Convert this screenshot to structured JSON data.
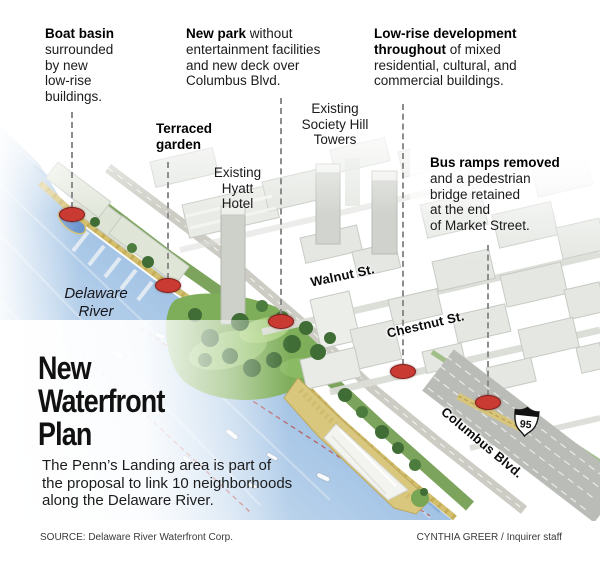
{
  "page": {
    "title_lines": "New\nWaterfront\nPlan",
    "description": "The Penn’s Landing area is part of\nthe proposal to link 10 neighborhoods\nalong the Delaware River."
  },
  "callouts": {
    "boat_basin": {
      "lead": "Boat basin\n",
      "rest": "surrounded\nby new\nlow-rise\nbuildings."
    },
    "new_park": {
      "lead": "New park",
      "rest": " without\nentertainment facilities\nand new deck over\nColumbus Blvd."
    },
    "low_rise": {
      "lead": "Low-rise development\nthroughout",
      "rest": " of mixed\nresidential, cultural, and\ncommercial buildings."
    },
    "terraced_garden": {
      "lead": "Terraced\ngarden"
    },
    "bus_ramps": {
      "lead": "Bus ramps removed\n",
      "rest": "and a pedestrian\nbridge retained\nat the end\nof Market Street."
    }
  },
  "map_labels": {
    "hyatt": "Existing\nHyatt\nHotel",
    "society_hill": "Existing\nSociety Hill\nTowers",
    "delaware_river": "Delaware\nRiver",
    "walnut_st": "Walnut St.",
    "chestnut_st": "Chestnut St.",
    "columbus_blvd": "Columbus Blvd.",
    "interstate_number": "95"
  },
  "markers": [
    "boat-basin",
    "terraced-garden",
    "new-park",
    "low-rise-development",
    "bus-ramps"
  ],
  "footer": {
    "source": "SOURCE: Delaware River Waterfront Corp.",
    "credit": "CYNTHIA GREER / Inquirer staff"
  },
  "colors": {
    "marker_red": "#c93a33",
    "marker_border": "#7e1d1a",
    "leader_gray": "#8d8d8d",
    "water_blue": "#7fa9d9",
    "shore_tan": "#d3bf6e",
    "park_green": "#6f9b52",
    "building_gray": "#e4e7e2",
    "highway_gray": "#babdb7",
    "text_black": "#141414"
  }
}
